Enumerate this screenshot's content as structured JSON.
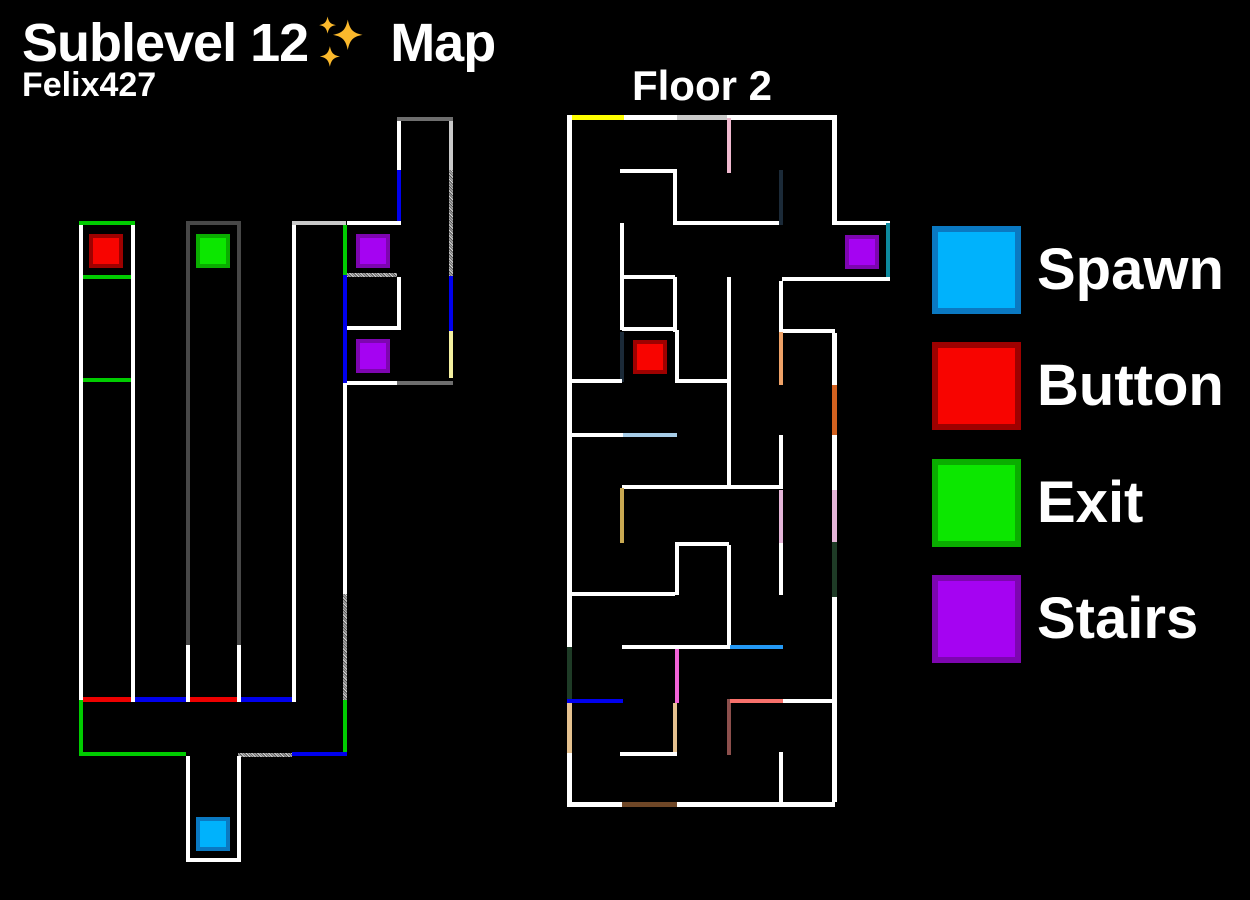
{
  "header": {
    "title_part1": "Sublevel 12",
    "title_part2": "Map",
    "author": "Felix427"
  },
  "floor2_label": "Floor 2",
  "palette": {
    "walls": {
      "white": "#ffffff",
      "gray": "#474747",
      "gray2": "#6e6e6e",
      "lightgray": "#c9c9c9",
      "green": "#00cc00",
      "red": "#ee0000",
      "blue": "#0000ee",
      "yellow": "#ffff00",
      "paleyellow": "#f4f0a0",
      "pink": "#efb9cf",
      "pink2": "#e5b5d8",
      "navy": "#1b2a38",
      "teal": "#0d8a9e",
      "sandy": "#efa268",
      "tan": "#e5c18f",
      "orange": "#d2611f",
      "lightblue": "#a7cde8",
      "dodger": "#2499f5",
      "khaki": "#c9a952",
      "darkgreen": "#1e3b26",
      "magenta": "#f263d8",
      "salmon": "#f8716b",
      "maroon": "#8c4f4c",
      "brown": "#6f4727"
    },
    "squares": {
      "spawn": {
        "fill": "#00b2fc",
        "border": "#0a79c2"
      },
      "button": {
        "fill": "#f80400",
        "border": "#9e0100"
      },
      "exit": {
        "fill": "#0ce700",
        "border": "#0aad00"
      },
      "stairs": {
        "fill": "#a503f2",
        "border": "#7d05b0"
      }
    }
  },
  "legend": {
    "items": [
      {
        "type": "spawn",
        "label": "Spawn"
      },
      {
        "type": "button",
        "label": "Button"
      },
      {
        "type": "exit",
        "label": "Exit"
      },
      {
        "type": "stairs",
        "label": "Stairs"
      }
    ]
  },
  "maps": [
    {
      "name": "sublevel-map",
      "walls": [
        [
          79,
          221,
          56,
          4,
          "green"
        ],
        [
          79,
          225,
          4,
          475,
          "white"
        ],
        [
          79,
          700,
          4,
          56,
          "green"
        ],
        [
          131,
          225,
          4,
          477,
          "white"
        ],
        [
          83,
          275,
          48,
          4,
          "green"
        ],
        [
          83,
          378,
          48,
          4,
          "green"
        ],
        [
          83,
          697,
          48,
          5,
          "red"
        ],
        [
          135,
          697,
          51,
          5,
          "blue"
        ],
        [
          186,
          221,
          55,
          4,
          "gray"
        ],
        [
          186,
          225,
          4,
          420,
          "gray"
        ],
        [
          186,
          645,
          4,
          57,
          "white"
        ],
        [
          237,
          225,
          4,
          420,
          "gray"
        ],
        [
          237,
          645,
          4,
          57,
          "white"
        ],
        [
          190,
          697,
          47,
          5,
          "red"
        ],
        [
          241,
          697,
          51,
          5,
          "blue"
        ],
        [
          292,
          221,
          54,
          4,
          "lightgray"
        ],
        [
          292,
          225,
          4,
          477,
          "white"
        ],
        [
          343,
          225,
          4,
          50,
          "green"
        ],
        [
          343,
          275,
          4,
          108,
          "blue"
        ],
        [
          343,
          383,
          4,
          211,
          "white"
        ],
        [
          343,
          594,
          4,
          106,
          "stipple"
        ],
        [
          343,
          700,
          4,
          56,
          "green"
        ],
        [
          397,
          117,
          56,
          4,
          "gray2"
        ],
        [
          397,
          121,
          4,
          49,
          "white"
        ],
        [
          397,
          170,
          4,
          53,
          "blue"
        ],
        [
          449,
          121,
          4,
          49,
          "lightgray"
        ],
        [
          449,
          170,
          4,
          106,
          "stipple"
        ],
        [
          449,
          276,
          4,
          55,
          "blue"
        ],
        [
          449,
          331,
          4,
          47,
          "paleyellow"
        ],
        [
          347,
          221,
          54,
          4,
          "white"
        ],
        [
          347,
          273,
          50,
          4,
          "stipple"
        ],
        [
          397,
          277,
          4,
          49,
          "white"
        ],
        [
          347,
          326,
          54,
          4,
          "white"
        ],
        [
          347,
          381,
          50,
          4,
          "white"
        ],
        [
          397,
          381,
          56,
          4,
          "gray2"
        ],
        [
          79,
          752,
          107,
          4,
          "green"
        ],
        [
          238,
          753,
          54,
          4,
          "stipple"
        ],
        [
          292,
          752,
          55,
          4,
          "blue"
        ],
        [
          186,
          756,
          4,
          106,
          "white"
        ],
        [
          237,
          756,
          4,
          106,
          "white"
        ],
        [
          186,
          858,
          55,
          4,
          "white"
        ]
      ],
      "squares": [
        {
          "type": "button",
          "x": 89,
          "y": 234
        },
        {
          "type": "exit",
          "x": 196,
          "y": 234
        },
        {
          "type": "stairs",
          "x": 356,
          "y": 234
        },
        {
          "type": "stairs",
          "x": 356,
          "y": 339
        },
        {
          "type": "spawn",
          "x": 196,
          "y": 817
        }
      ]
    },
    {
      "name": "floor2-map",
      "walls": [
        [
          567,
          115,
          270,
          5,
          "white"
        ],
        [
          572,
          115,
          52,
          5,
          "yellow"
        ],
        [
          677,
          115,
          50,
          5,
          "lightgray"
        ],
        [
          567,
          115,
          5,
          692,
          "white"
        ],
        [
          567,
          647,
          5,
          53,
          "darkgreen"
        ],
        [
          567,
          703,
          5,
          50,
          "tan"
        ],
        [
          567,
          802,
          268,
          5,
          "white"
        ],
        [
          622,
          802,
          55,
          5,
          "brown"
        ],
        [
          832,
          115,
          5,
          108,
          "white"
        ],
        [
          832,
          221,
          58,
          4,
          "white"
        ],
        [
          886,
          223,
          4,
          57,
          "teal"
        ],
        [
          782,
          277,
          108,
          4,
          "white"
        ],
        [
          779,
          281,
          4,
          51,
          "white"
        ],
        [
          783,
          329,
          52,
          4,
          "white"
        ],
        [
          832,
          333,
          5,
          52,
          "white"
        ],
        [
          832,
          385,
          5,
          50,
          "orange"
        ],
        [
          832,
          435,
          5,
          55,
          "white"
        ],
        [
          832,
          490,
          5,
          52,
          "pink2"
        ],
        [
          832,
          542,
          5,
          55,
          "darkgreen"
        ],
        [
          832,
          597,
          5,
          205,
          "white"
        ],
        [
          727,
          118,
          4,
          55,
          "pink"
        ],
        [
          620,
          169,
          56,
          4,
          "white"
        ],
        [
          673,
          169,
          4,
          56,
          "white"
        ],
        [
          676,
          221,
          107,
          4,
          "white"
        ],
        [
          779,
          170,
          4,
          55,
          "navy"
        ],
        [
          620,
          223,
          4,
          107,
          "white"
        ],
        [
          624,
          275,
          51,
          4,
          "white"
        ],
        [
          673,
          277,
          4,
          55,
          "white"
        ],
        [
          727,
          277,
          4,
          211,
          "white"
        ],
        [
          622,
          327,
          54,
          4,
          "white"
        ],
        [
          620,
          332,
          4,
          50,
          "navy"
        ],
        [
          675,
          330,
          4,
          53,
          "white"
        ],
        [
          570,
          379,
          52,
          4,
          "white"
        ],
        [
          677,
          379,
          50,
          4,
          "white"
        ],
        [
          570,
          433,
          53,
          4,
          "white"
        ],
        [
          623,
          433,
          54,
          4,
          "lightblue"
        ],
        [
          779,
          332,
          4,
          53,
          "sandy"
        ],
        [
          779,
          435,
          4,
          53,
          "white"
        ],
        [
          622,
          485,
          161,
          4,
          "white"
        ],
        [
          620,
          488,
          4,
          55,
          "khaki"
        ],
        [
          779,
          490,
          4,
          53,
          "pink2"
        ],
        [
          675,
          542,
          54,
          4,
          "white"
        ],
        [
          675,
          545,
          4,
          50,
          "white"
        ],
        [
          727,
          545,
          4,
          100,
          "white"
        ],
        [
          779,
          543,
          4,
          52,
          "white"
        ],
        [
          570,
          592,
          105,
          4,
          "white"
        ],
        [
          622,
          645,
          108,
          4,
          "white"
        ],
        [
          730,
          645,
          53,
          4,
          "dodger"
        ],
        [
          675,
          649,
          4,
          54,
          "magenta"
        ],
        [
          567,
          699,
          56,
          4,
          "blue"
        ],
        [
          673,
          703,
          4,
          50,
          "tan"
        ],
        [
          727,
          699,
          4,
          56,
          "maroon"
        ],
        [
          730,
          699,
          53,
          4,
          "salmon"
        ],
        [
          783,
          699,
          50,
          4,
          "white"
        ],
        [
          620,
          752,
          57,
          4,
          "white"
        ],
        [
          779,
          752,
          4,
          50,
          "white"
        ]
      ],
      "squares": [
        {
          "type": "stairs",
          "x": 845,
          "y": 235
        },
        {
          "type": "button",
          "x": 633,
          "y": 340
        }
      ]
    }
  ]
}
